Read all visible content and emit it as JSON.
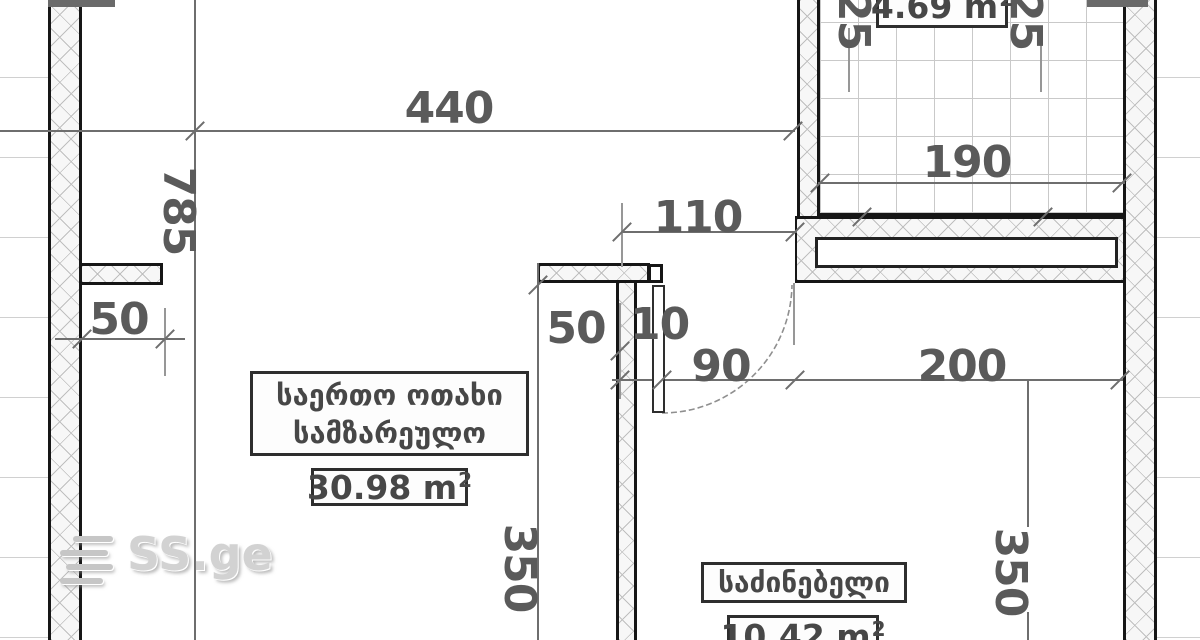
{
  "plan": {
    "dimensions": {
      "width_440": "440",
      "height_785": "785",
      "offset_110": "110",
      "left_50": "50",
      "mid_50": "50",
      "door_gap_10": "10",
      "door_90": "90",
      "right_200": "200",
      "balcony_190": "190",
      "balcony_25_left": "25",
      "balcony_25_right": "25",
      "room_350_left": "350",
      "room_350_right": "350"
    },
    "rooms": {
      "living": {
        "name_line1": "საერთო ოთახი",
        "name_line2": "სამზარეულო",
        "area_value": "30.98 m",
        "area_sup": "2"
      },
      "bedroom": {
        "name": "საძინებელი",
        "area_value": "10.42 m",
        "area_sup": "2"
      },
      "balcony": {
        "area_value": "4.69 m",
        "area_sup": "2"
      }
    },
    "watermark": {
      "text": "SS.ge"
    },
    "colors": {
      "wall_line": "#161616",
      "dim_line": "#6e6e6e",
      "dim_text": "#5a5a5a",
      "label_text": "#474747",
      "watermark_text": "#d2d2d2"
    }
  }
}
